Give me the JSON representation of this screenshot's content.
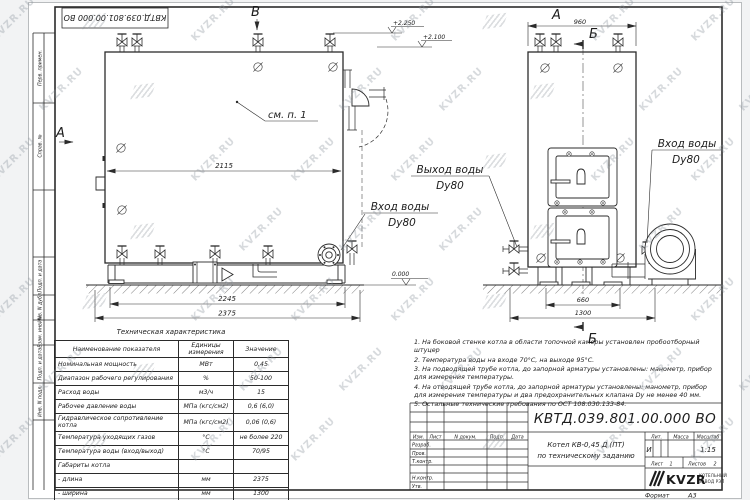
{
  "watermark": {
    "text": "KVZR.RU"
  },
  "frame": {
    "top_stamp": "КВТД.039.801.00.000 ВО",
    "side_labels": [
      "Перв. примен.",
      "Справ. №",
      "Подп. и дата",
      "Инв. N дубл.",
      "Взам. инв. N",
      "Подп. и дата",
      "Инв. N подл."
    ]
  },
  "views": {
    "front": {
      "section_a": "А",
      "section_b": "В",
      "note_ref": "см. п. 1",
      "dim_inner": "2115",
      "dim_base": "2245",
      "dim_overall": "2375",
      "elev_top": "+2.250",
      "elev_mid": "+2.100",
      "elev_zero": "0.000",
      "label_inlet_line1": "Вход воды",
      "label_inlet_line2": "Dy80"
    },
    "side": {
      "view_label": "А",
      "section_label": "Б",
      "dim_top": "960",
      "dim_base": "660",
      "dim_overall": "1300",
      "label_outlet_line1": "Выход воды",
      "label_outlet_line2": "Dy80",
      "label_inlet_line1": "Вход воды",
      "label_inlet_line2": "Dy80"
    }
  },
  "tech_table": {
    "title": "Техническая характеристика",
    "headers": [
      "Наименование показателя",
      "Единицы измерения",
      "Значение"
    ],
    "rows": [
      [
        "Номинальная мощность",
        "МВт",
        "0,45"
      ],
      [
        "Диапазон рабочего регулирования",
        "%",
        "50-100"
      ],
      [
        "Расход воды",
        "м3/ч",
        "15"
      ],
      [
        "Рабочее давление воды",
        "МПа (кгс/см2)",
        "0,6 (6,0)"
      ],
      [
        "Гидравлическое сопротивление котла",
        "МПа (кгс/см2)",
        "0,06 (0,6)"
      ],
      [
        "Температура уходящих газов",
        "°С",
        "не более 220"
      ],
      [
        "Температура воды (вход/выход)",
        "°С",
        "70/95"
      ],
      [
        "Габариты котла",
        "",
        ""
      ],
      [
        "   - длина",
        "мм",
        "2375"
      ],
      [
        "   - ширина",
        "мм",
        "1300"
      ],
      [
        "   - высота",
        "мм",
        "2250"
      ]
    ]
  },
  "notes": [
    "1. На боковой стенке котла в области топочной камеры установлен пробоотборный штуцер",
    "2. Температура воды на входе 70°С, на выходе 95°С.",
    "3. На подводящей трубе котла, до запорной арматуры установлены: манометр, прибор для измерения температуры.",
    "4. На отводящей трубе котла, до запорной арматуры установлены: манометр, прибор для измерения температуры и два предохранительных клапана Dу не менее 40 мм.",
    "5. Остальные технические требования по ОСТ 108.030.133-84."
  ],
  "title_block": {
    "doc_number": "КВТД.039.801.00.000 ВО",
    "cols": [
      "Изм.",
      "Лист",
      "N докум.",
      "Подп.",
      "Дата"
    ],
    "row_labels": [
      "Разраб.",
      "Пров.",
      "Т.контр.",
      "Н.контр.",
      "Утв."
    ],
    "product_line1": "Котел КВ-0,45 Д (ПТ)",
    "product_line2": "по техническому заданию",
    "lit_label": "Лит.",
    "lit_value": "И",
    "mass_label": "Масса",
    "scale_label": "Масштаб",
    "scale_value": "1:15",
    "sheet_label": "Лист",
    "sheet_num": "1",
    "sheets_label": "Листов",
    "sheets_num": "2",
    "company": "KVZR",
    "company_line1": "КОТЕЛЬНЫЙ",
    "company_line2": "ЗАВОД РЭП",
    "format_label": "Формат",
    "format_value": "А3"
  }
}
